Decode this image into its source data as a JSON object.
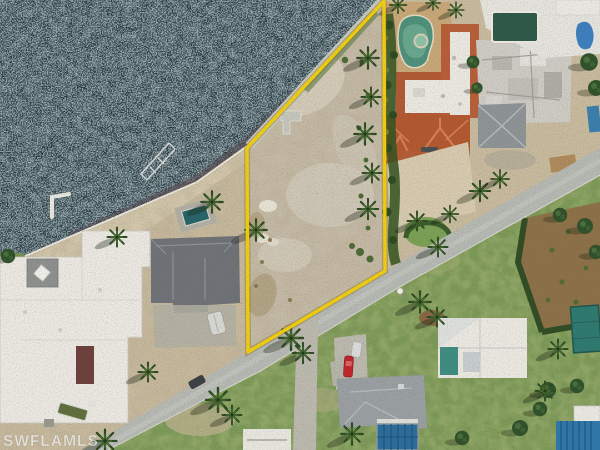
{
  "watermark": {
    "text": "SWFLAMLS"
  },
  "colors": {
    "water": "#223840",
    "dirt": "#c9bb9e",
    "lot_dirt": "#c6bca8",
    "sand": "#d5c9ad",
    "road": "#b7bab4",
    "driveway": "#bdbab0",
    "lawn": "#7d9a58",
    "boundary_yellow": "#f4cf0c",
    "terracotta_roof": "#b85f38",
    "kidney_pool": "#4e917c",
    "screened_pool": "#2a6d9e",
    "dark_pool": "#2d5948",
    "corner_pool": "#2f78ab",
    "white_roof": "#eceae3",
    "gray_roof": "#6f7277"
  }
}
